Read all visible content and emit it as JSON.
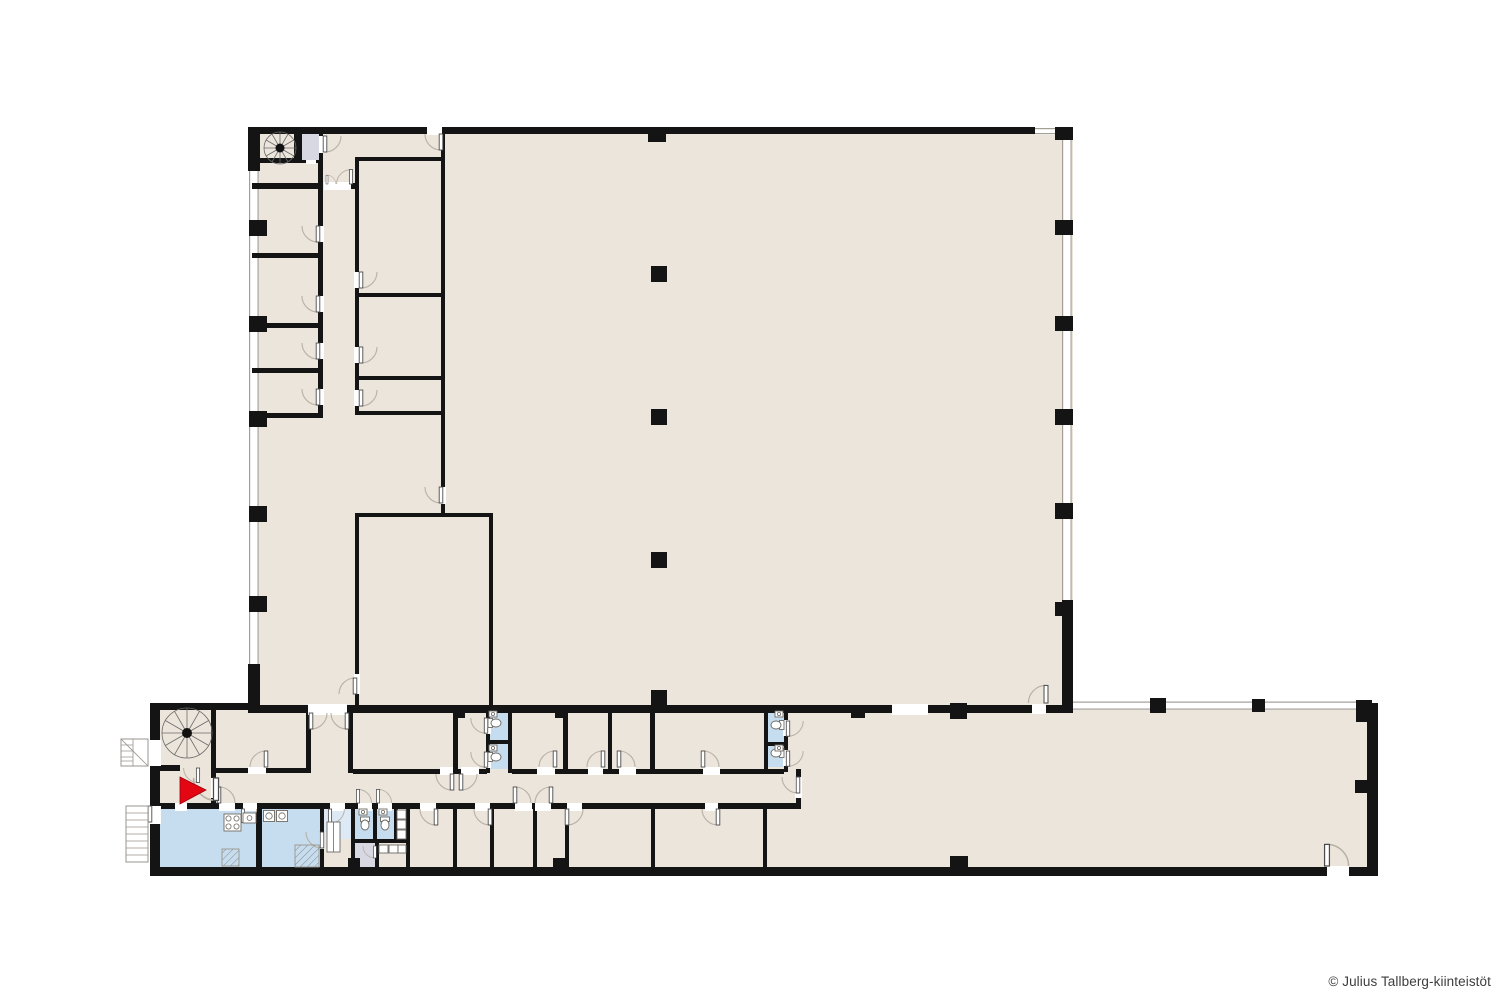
{
  "palette": {
    "floor": "#ece5dc",
    "wet": "#c6ddf0",
    "wet_light": "#dde9f5",
    "service": "#d8d8e3",
    "wall": "#141414",
    "window_line": "#a49e95",
    "door_arc": "#b9b1a5",
    "accent": "#e30613",
    "text": "#3d3d3d",
    "background": "#ffffff"
  },
  "footer": {
    "copyright": "© Julius Tallberg-kiinteistöt"
  },
  "features": {
    "entrance_marker": "red-entrance-arrow",
    "staircases": [
      "spiral-staircase-main",
      "spiral-staircase-entrance",
      "external-stairs-upper",
      "external-stairs-lower"
    ],
    "elevator": "elevator-shaft",
    "wet_rooms": [
      "kitchen",
      "washroom",
      "wc-cluster-southwest",
      "wc-pair-west",
      "wc-pair-east"
    ],
    "service_room": "cleaning-room",
    "fixtures": [
      "stove",
      "toilets",
      "sinks",
      "washing-machines",
      "bench",
      "shower-hatch"
    ]
  }
}
